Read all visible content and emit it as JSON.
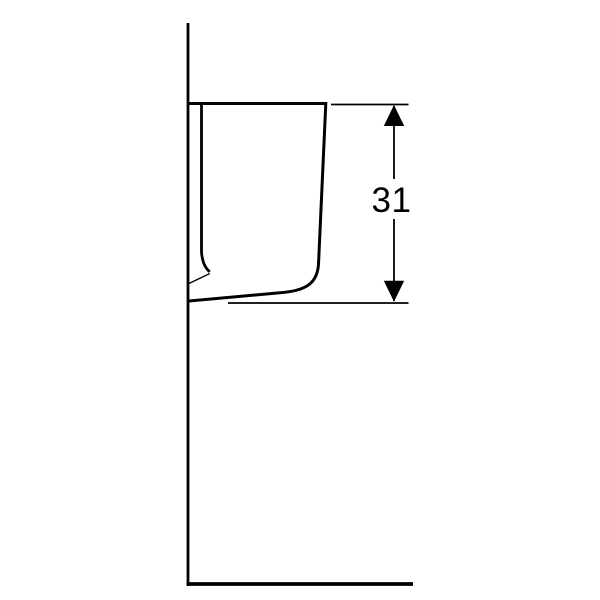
{
  "drawing": {
    "background_color": "#ffffff",
    "line_color": "#000000",
    "dimension": {
      "label": "31"
    },
    "icons": {
      "arrow_up": "▲",
      "arrow_down": "▼"
    }
  }
}
